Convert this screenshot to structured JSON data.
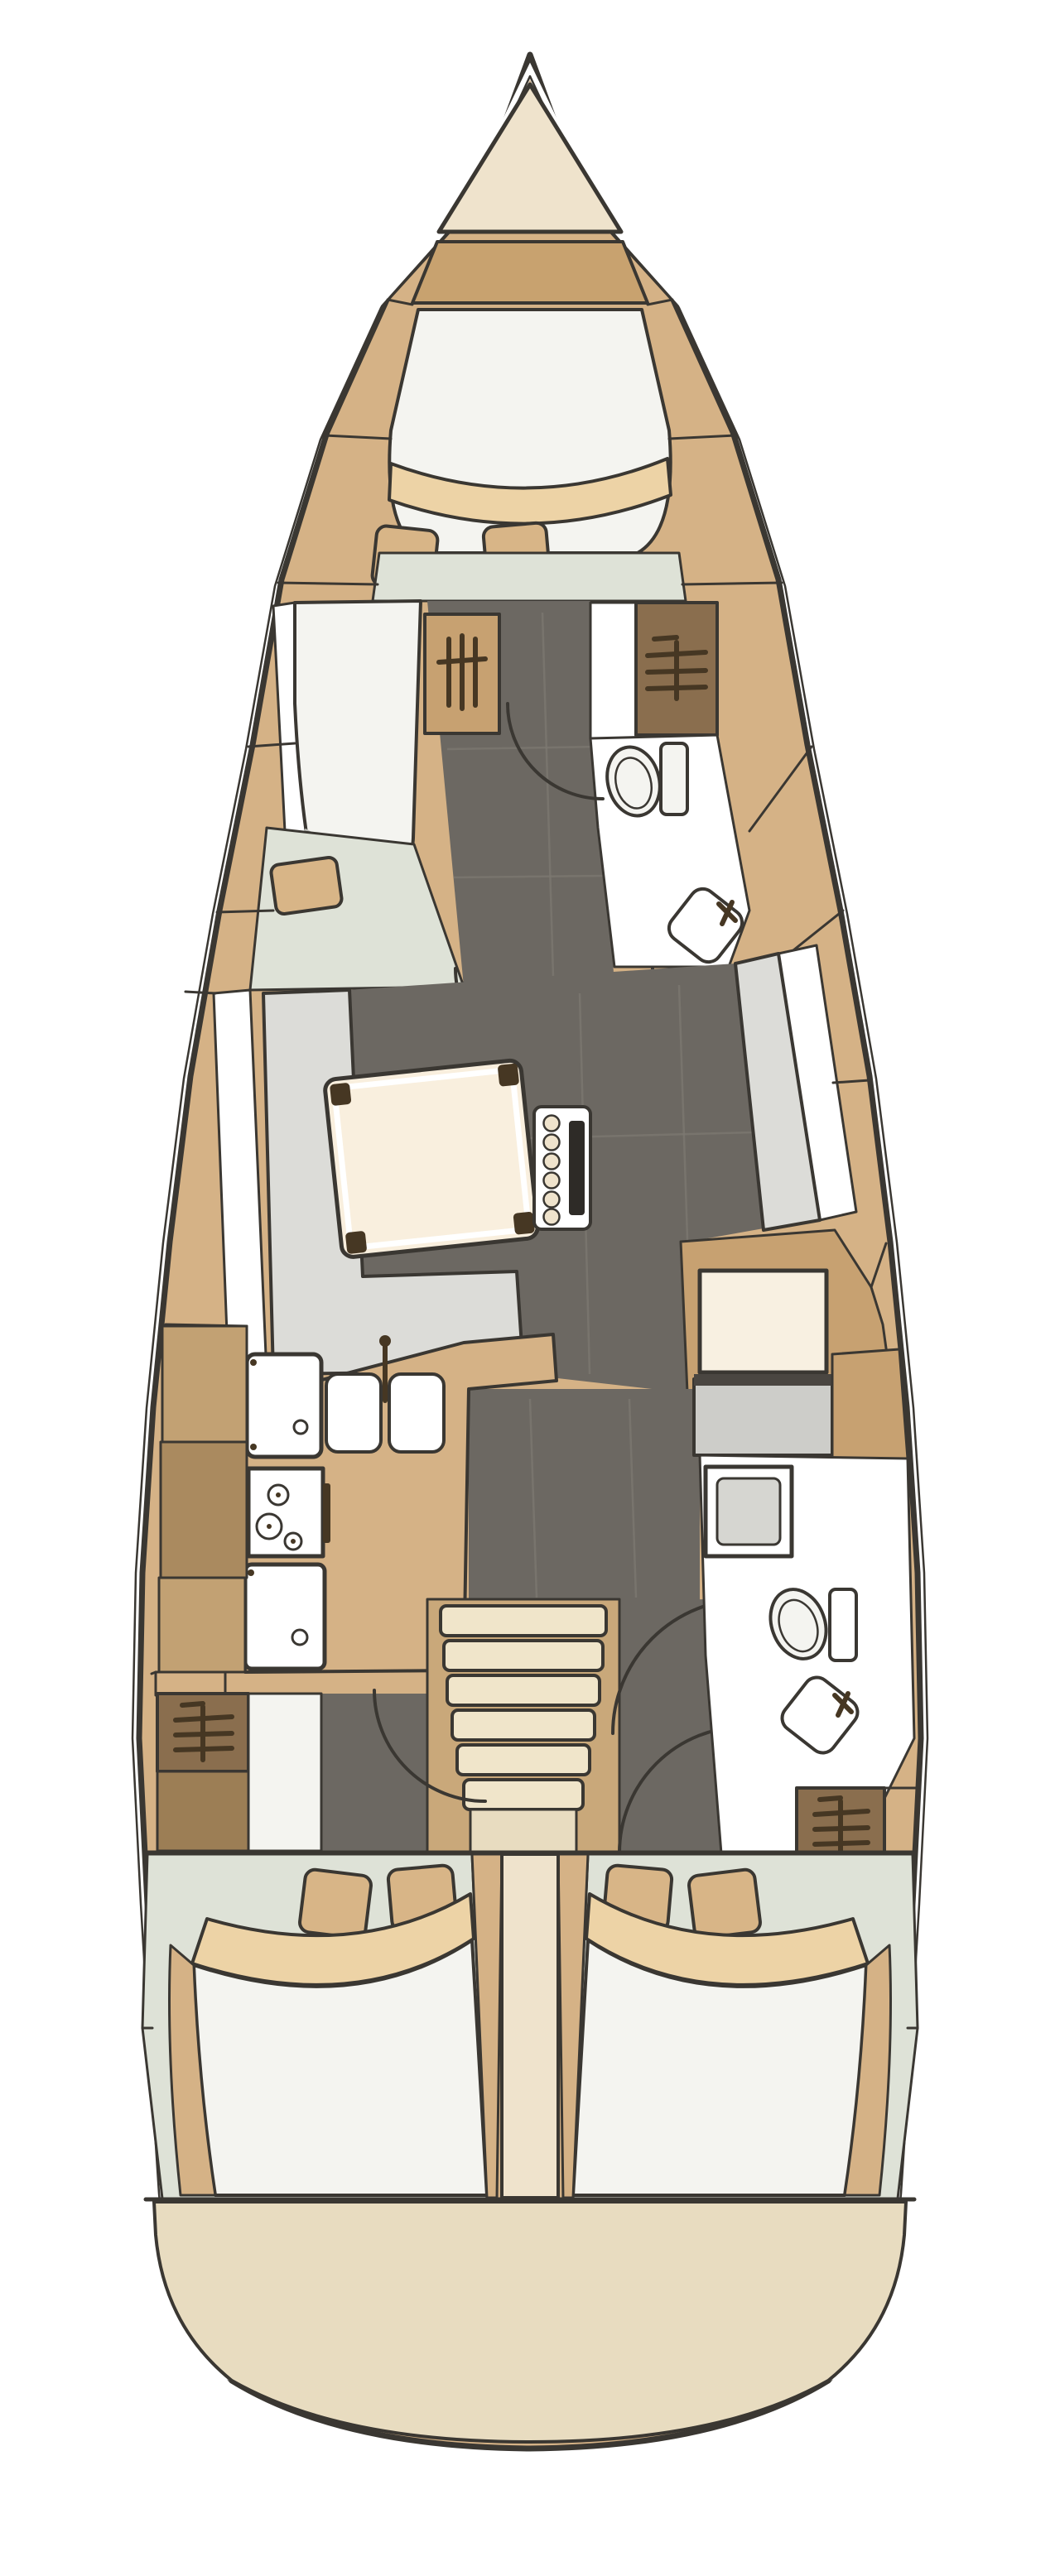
{
  "diagram": {
    "type": "yacht-interior-floor-plan",
    "view": "top-down deck plan, bow at top, stern at bottom",
    "vessel": "sailing monohull cruising yacht",
    "text_on_image": "none"
  },
  "palette": {
    "page_bg": "#ffffff",
    "outline": "#3a3732",
    "hull_side": "#d5b286",
    "band_tan": "#c8a26f",
    "wardrobe_tan": "#c7a171",
    "locker_brown": "#aa8a5f",
    "locker_light": "#c2a173",
    "wardrobe_dark": "#8a6e4e",
    "icon_dark": "#463723",
    "floor_dark": "#6c6862",
    "floor_seam": "#7d7971",
    "settee_gray": "#dcdcd8",
    "shower_gray": "#d6d6d1",
    "bench_gray": "#cdcdc9",
    "bench_edge": "#4a4641",
    "pure_white": "#ffffff",
    "off_white": "#f4f4f0",
    "cream": "#efe3cc",
    "table_cream": "#f9efde",
    "seat_cream": "#f8f0e1",
    "green_floor": "#dee2d7",
    "pillow_tan": "#d8b587",
    "blanket_tan": "#edd3a6",
    "transom_beige": "#e8dcc0",
    "steps_cream": "#f0e5ca",
    "steps_back": "#c9a87a",
    "slot_dark": "#2e2b27",
    "fold_gray": "#b9b9b4"
  },
  "areas": {
    "hull": {
      "label": "hull outline with inner liner line"
    },
    "anchor_locker": {
      "label": "anchor locker at bow"
    },
    "bow_band": {
      "label": "bow bulkhead band"
    },
    "owner_cabin": {
      "label": "forward owner cabin with V-berth",
      "pillows": 2,
      "extra_cushion": 1
    },
    "fwd_berth_extension": {
      "label": "port berth extension in forward cabin"
    },
    "fwd_wardrobe_hanging": {
      "label": "hanging wardrobe, forward cabin"
    },
    "fwd_head": {
      "label": "forward head with toilet and corner sink"
    },
    "fwd_head_wardrobe": {
      "label": "shelved locker at forward head"
    },
    "corridor": {
      "label": "central companionway corridor, dark floor"
    },
    "salon": {
      "label": "salon with L-settee, dining table and bottle rack"
    },
    "dining_table": {
      "label": "folding dining table",
      "corner_pads": 4
    },
    "bottle_rack": {
      "label": "mast console with bottle rack",
      "bottles": 6
    },
    "port_settee": {
      "label": "port L-shaped settee"
    },
    "stbd_settee": {
      "label": "starboard settee"
    },
    "nav_seat": {
      "label": "navigation / chart seat"
    },
    "galley": {
      "label": "port galley",
      "burners": 3,
      "sink_bowls": 2
    },
    "fridge": {
      "label": "top-loading fridge"
    },
    "stove": {
      "label": "gimballed stove"
    },
    "oven": {
      "label": "oven / front-opening cooler"
    },
    "companionway_steps": {
      "label": "companionway steps",
      "treads": 6
    },
    "aft_head": {
      "label": "starboard aft head with shower, toilet and sink"
    },
    "port_lockers": {
      "label": "port side lockers and shelved wardrobe"
    },
    "stbd_wardrobe": {
      "label": "starboard shelved wardrobe"
    },
    "port_aft_cabin": {
      "label": "port aft double cabin",
      "pillows": 2
    },
    "stbd_aft_cabin": {
      "label": "starboard aft double cabin",
      "pillows": 2
    },
    "center_divider": {
      "label": "centerline divider between aft cabins"
    },
    "transom": {
      "label": "rounded stern transom"
    }
  },
  "icons": {
    "shelf_icon": "shelved locker symbol (vertical line with horizontal shelf bars)",
    "hanging_icon": "hanging wardrobe symbol (vertical bars)",
    "door_arc_icon": "door swing arc",
    "burner_icon": "stove burner circles",
    "faucet_icon": "tap symbol"
  }
}
